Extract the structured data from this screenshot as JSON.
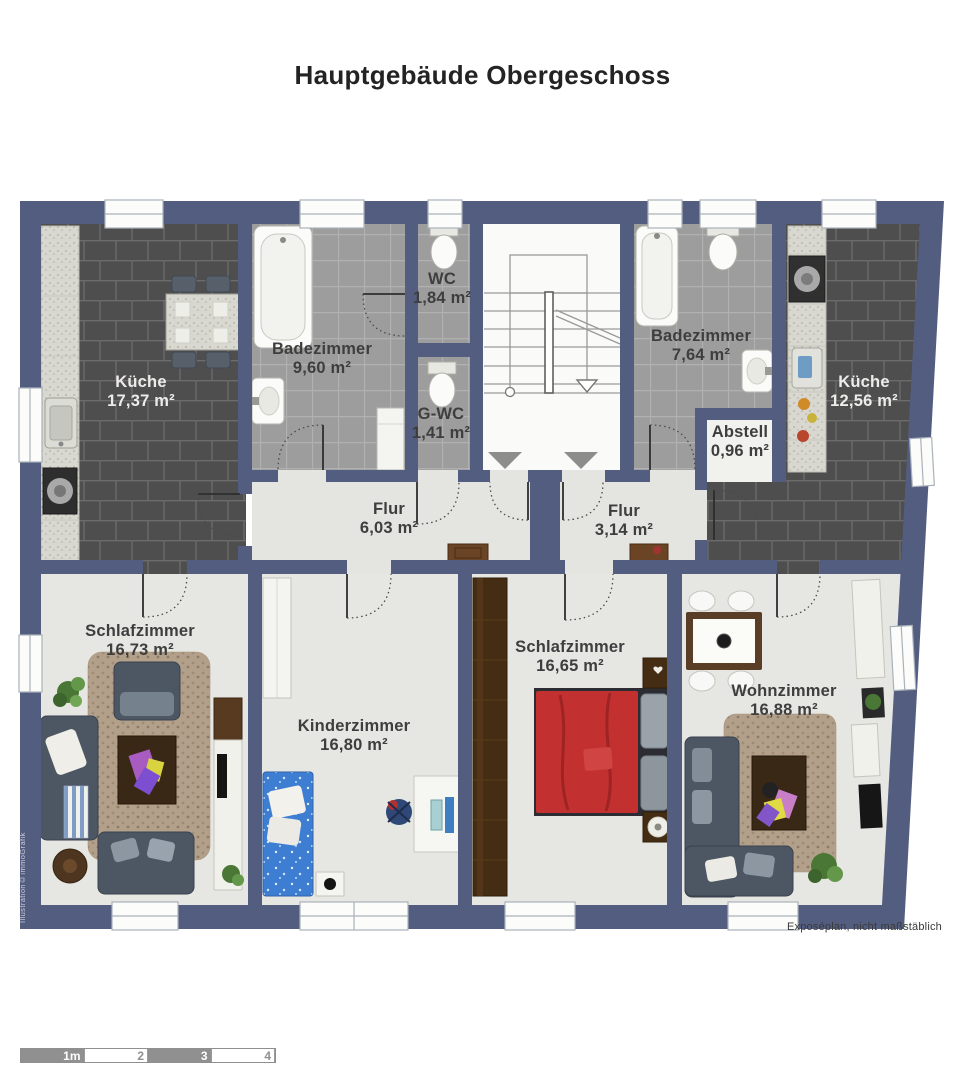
{
  "title": "Hauptgebäude Obergeschoss",
  "rooms": {
    "kueche_left": {
      "name": "Küche",
      "area": "17,37 m²"
    },
    "bad_left": {
      "name": "Badezimmer",
      "area": "9,60 m²"
    },
    "wc": {
      "name": "WC",
      "area": "1,84 m²"
    },
    "gwc": {
      "name": "G-WC",
      "area": "1,41 m²"
    },
    "bad_right": {
      "name": "Badezimmer",
      "area": "7,64 m²"
    },
    "abstell": {
      "name": "Abstell",
      "area": "0,96 m²"
    },
    "kueche_right": {
      "name": "Küche",
      "area": "12,56 m²"
    },
    "flur_left": {
      "name": "Flur",
      "area": "6,03 m²"
    },
    "flur_right": {
      "name": "Flur",
      "area": "3,14 m²"
    },
    "schlaf_left": {
      "name": "Schlafzimmer",
      "area": "16,73 m²"
    },
    "kinderzimmer": {
      "name": "Kinderzimmer",
      "area": "16,80 m²"
    },
    "schlaf_right": {
      "name": "Schlafzimmer",
      "area": "16,65 m²"
    },
    "wohnzimmer": {
      "name": "Wohnzimmer",
      "area": "16,88 m²"
    }
  },
  "footer_note": "Exposéplan, nicht maßstäblich",
  "credit": "Illustration©immoGrafik",
  "scale_bar": {
    "labels": [
      "1m",
      "2",
      "3",
      "4"
    ]
  },
  "colors": {
    "wall": "#535d80",
    "dark_tile": "#4e4e4e",
    "light_tile": "#9d9d9d",
    "floor": "#e4e4e0",
    "bed_red": "#c23030",
    "bed_blue": "#3e7ed2",
    "sofa_grey": "#4d5763",
    "wood_brown": "#452d14"
  }
}
